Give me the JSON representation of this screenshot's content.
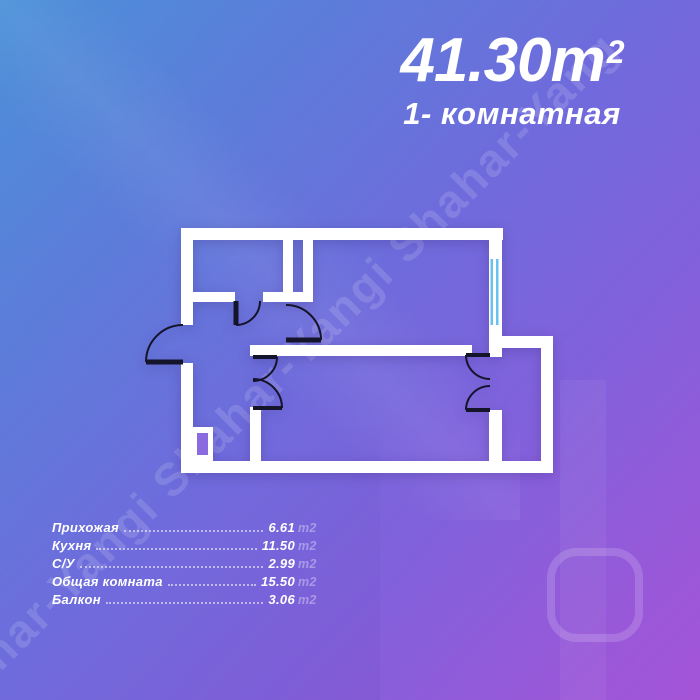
{
  "title": {
    "area": "41.30",
    "unit": "m",
    "superscript": "2",
    "subtitle": "1- комнатная"
  },
  "watermark": "har-Yangi Shahar-Yangi Shahar-Yang",
  "legend": [
    {
      "label": "Прихожая",
      "value": "6.61",
      "unit": "m2"
    },
    {
      "label": "Кухня",
      "value": "11.50",
      "unit": "m2"
    },
    {
      "label": "С/У",
      "value": "2.99",
      "unit": "m2"
    },
    {
      "label": "Общая комната",
      "value": "15.50",
      "unit": "m2"
    },
    {
      "label": "Балкон",
      "value": "3.06",
      "unit": "m2"
    }
  ],
  "floorplan": {
    "wall_color": "#ffffff",
    "door_color": "#14142a",
    "window_color": "#6ac1ee"
  },
  "colors": {
    "bg_top_left": "#4b90d8",
    "bg_middle": "#6f6bdc",
    "bg_bottom_right": "#a554d7"
  }
}
